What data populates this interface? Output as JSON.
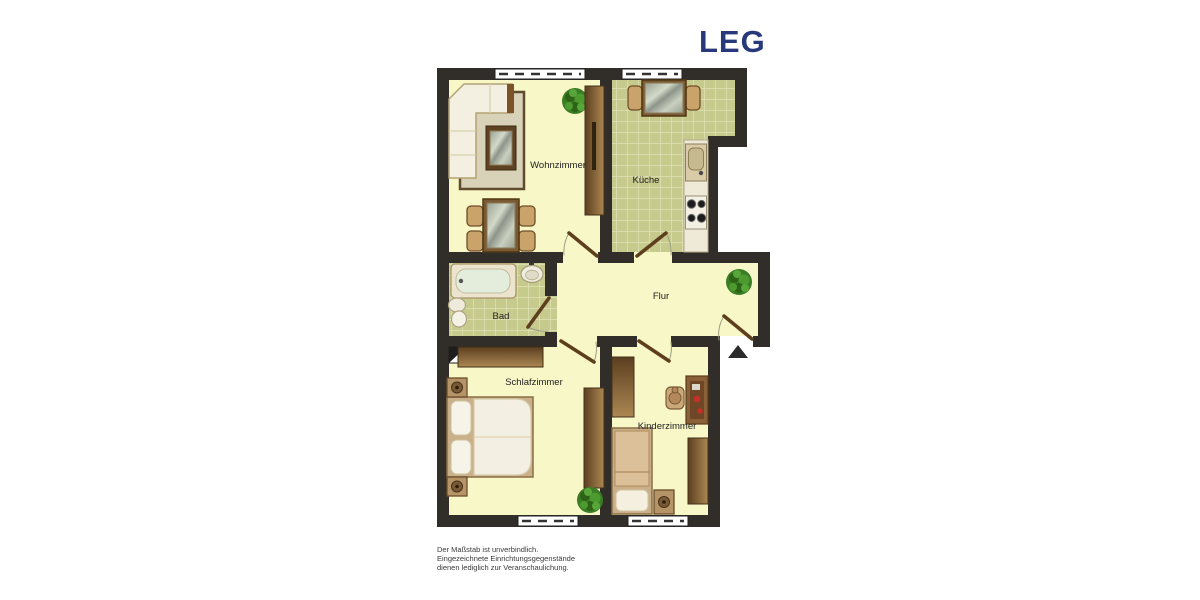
{
  "header": {
    "logo_text": "LEG",
    "logo_color": "#27397b"
  },
  "floorplan": {
    "type": "apartment-floor-plan",
    "rooms": {
      "wohnzimmer": {
        "label": "Wohnzimmer"
      },
      "kueche": {
        "label": "Küche"
      },
      "bad": {
        "label": "Bad"
      },
      "flur": {
        "label": "Flur"
      },
      "schlafzimmer": {
        "label": "Schlafzimmer"
      },
      "kinderzimmer": {
        "label": "Kinderzimmer"
      }
    },
    "colors": {
      "wall": "#312e29",
      "floor": "#f8f7c8",
      "tile": "#c6ca8d",
      "tile_grout": "#e0e3b6",
      "wood_dark": "#6e4e2a",
      "wood_light": "#c9a87a",
      "plant_green": "#3f8a28"
    }
  },
  "footer": {
    "disclaimer_lines": [
      "Der Maßstab ist unverbindlich.",
      "Eingezeichnete Einrichtungsgegenstände",
      "dienen lediglich zur Veranschaulichung."
    ]
  }
}
